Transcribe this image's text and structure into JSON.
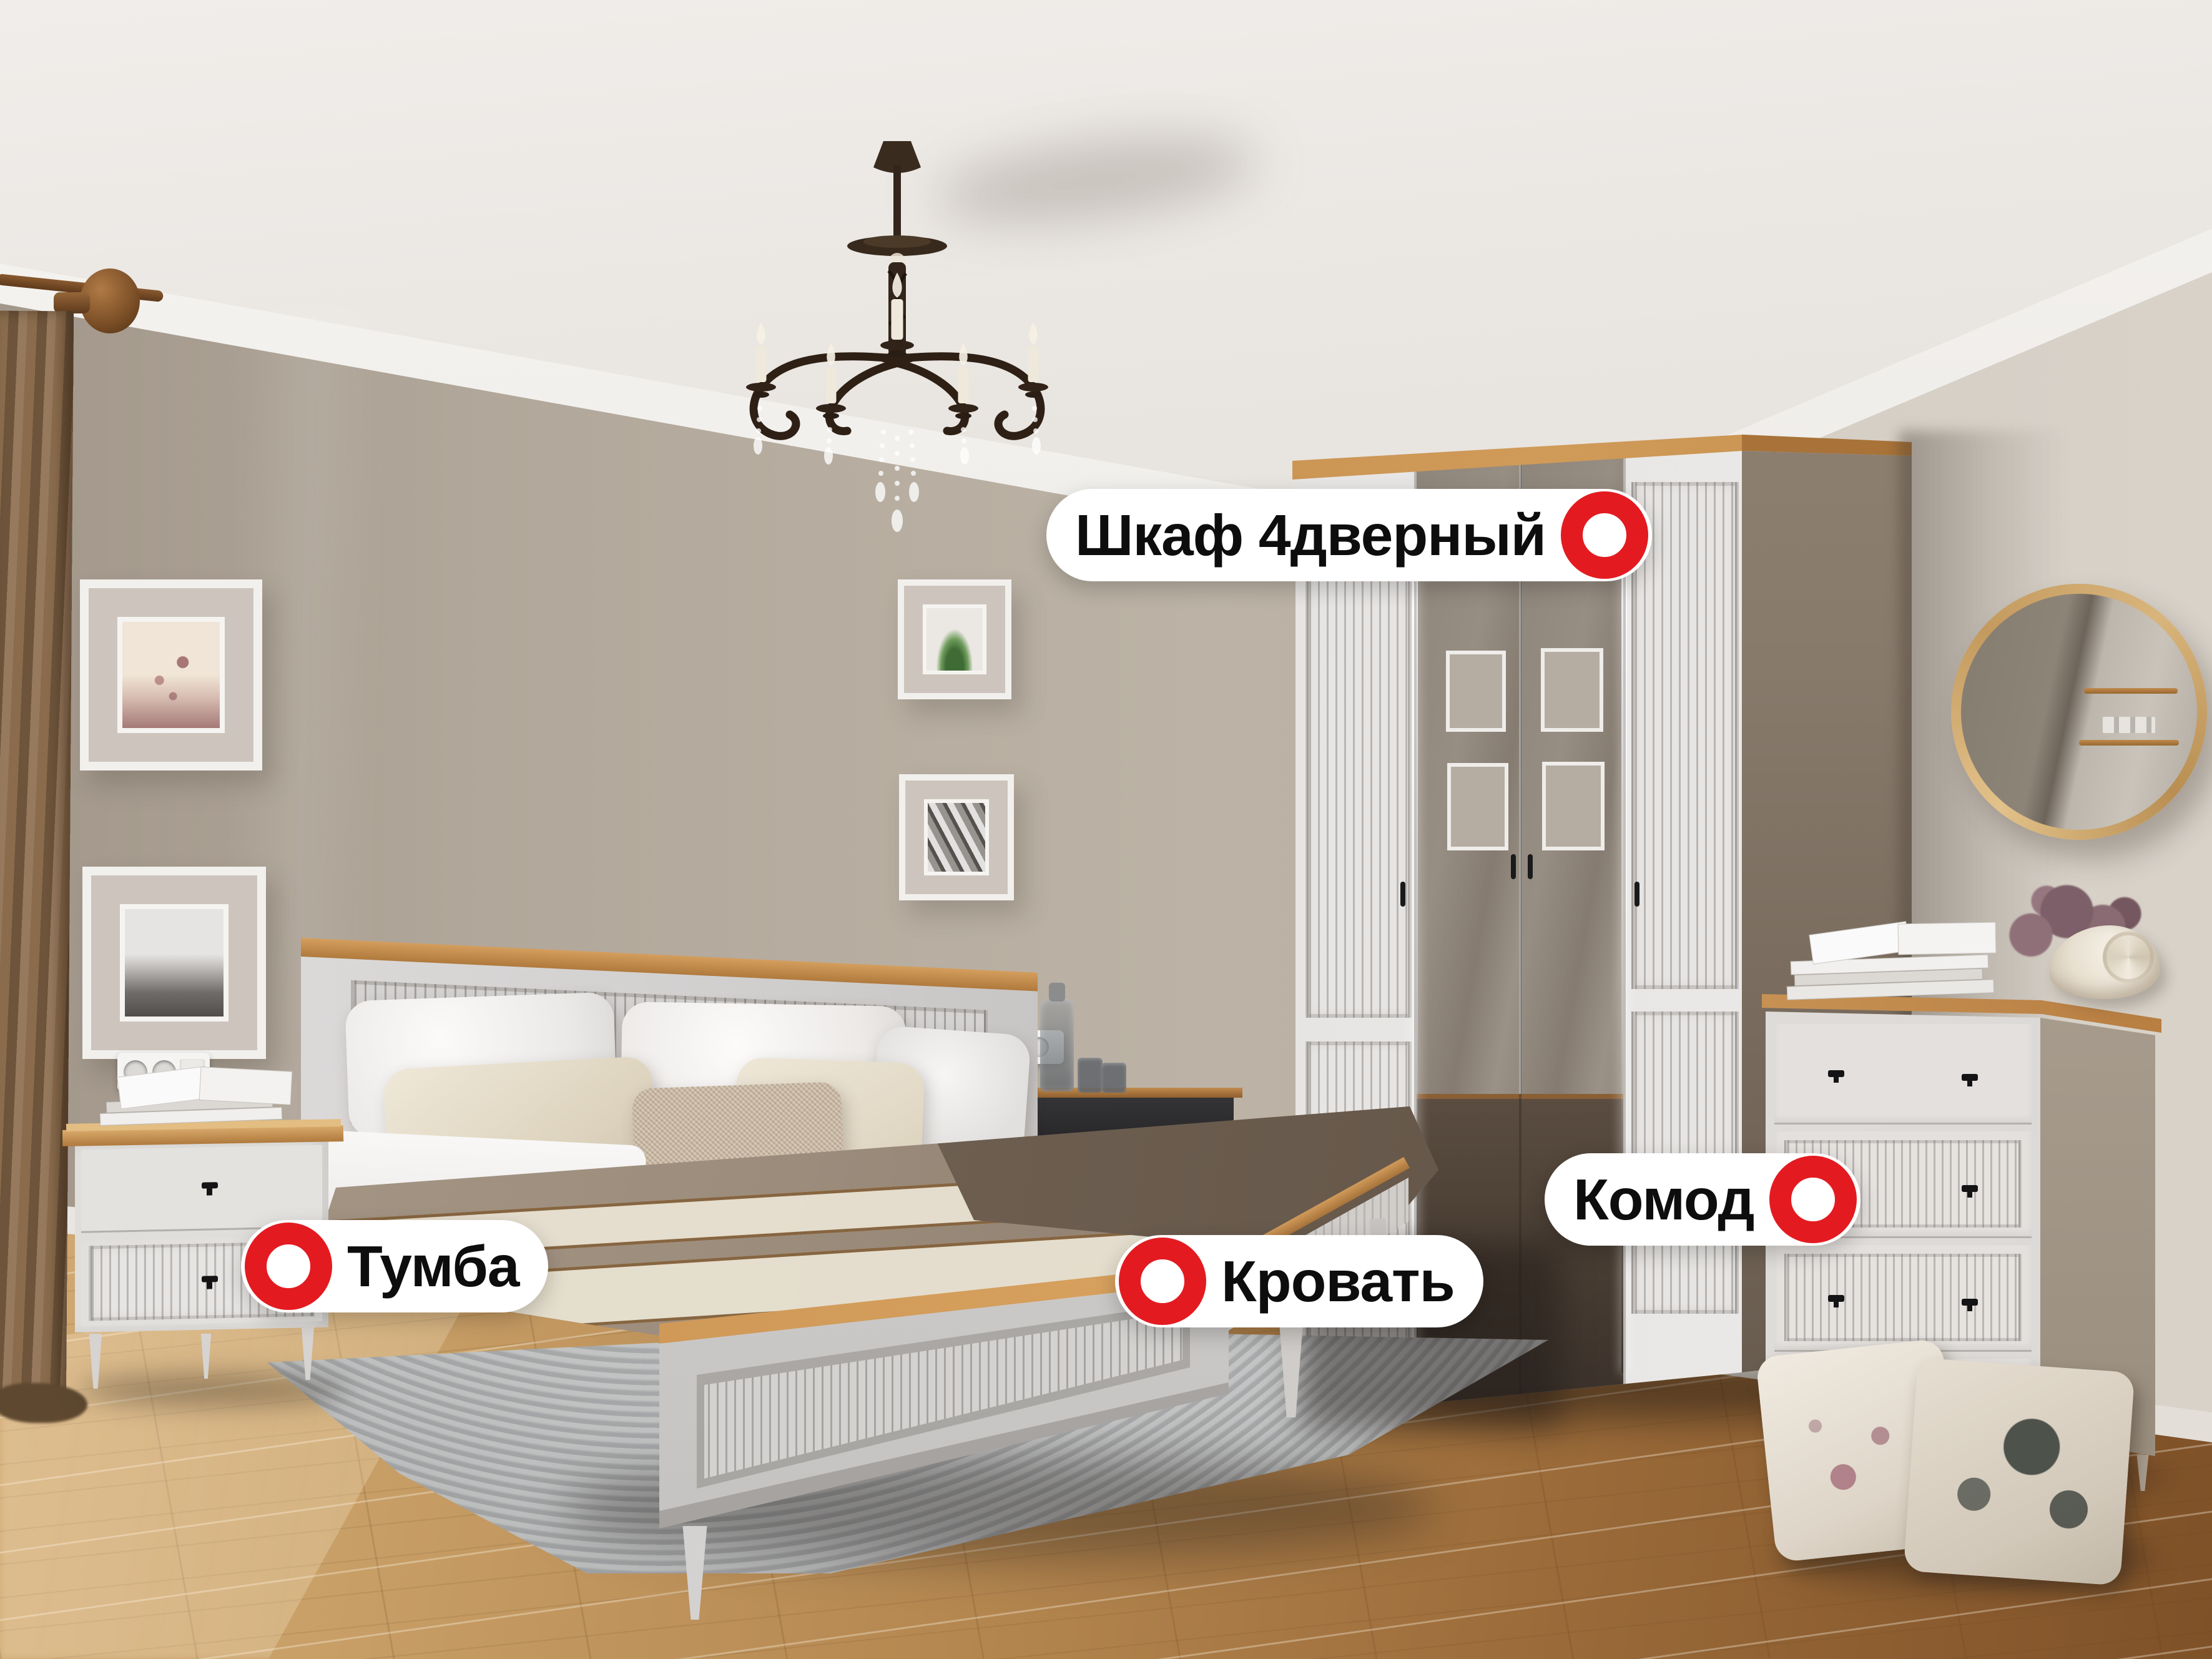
{
  "callouts": {
    "wardrobe": {
      "label": "Шкаф 4дверный"
    },
    "bed": {
      "label": "Кровать"
    },
    "nightstand": {
      "label": "Тумба"
    },
    "dresser": {
      "label": "Комод"
    }
  },
  "colors": {
    "marker_red": "#e31b20",
    "label_background": "#ffffff",
    "label_text": "#0d0d0d",
    "accent_oak": "#c08a4e"
  },
  "icons": {
    "hotspot": "hotspot-ring-icon"
  }
}
